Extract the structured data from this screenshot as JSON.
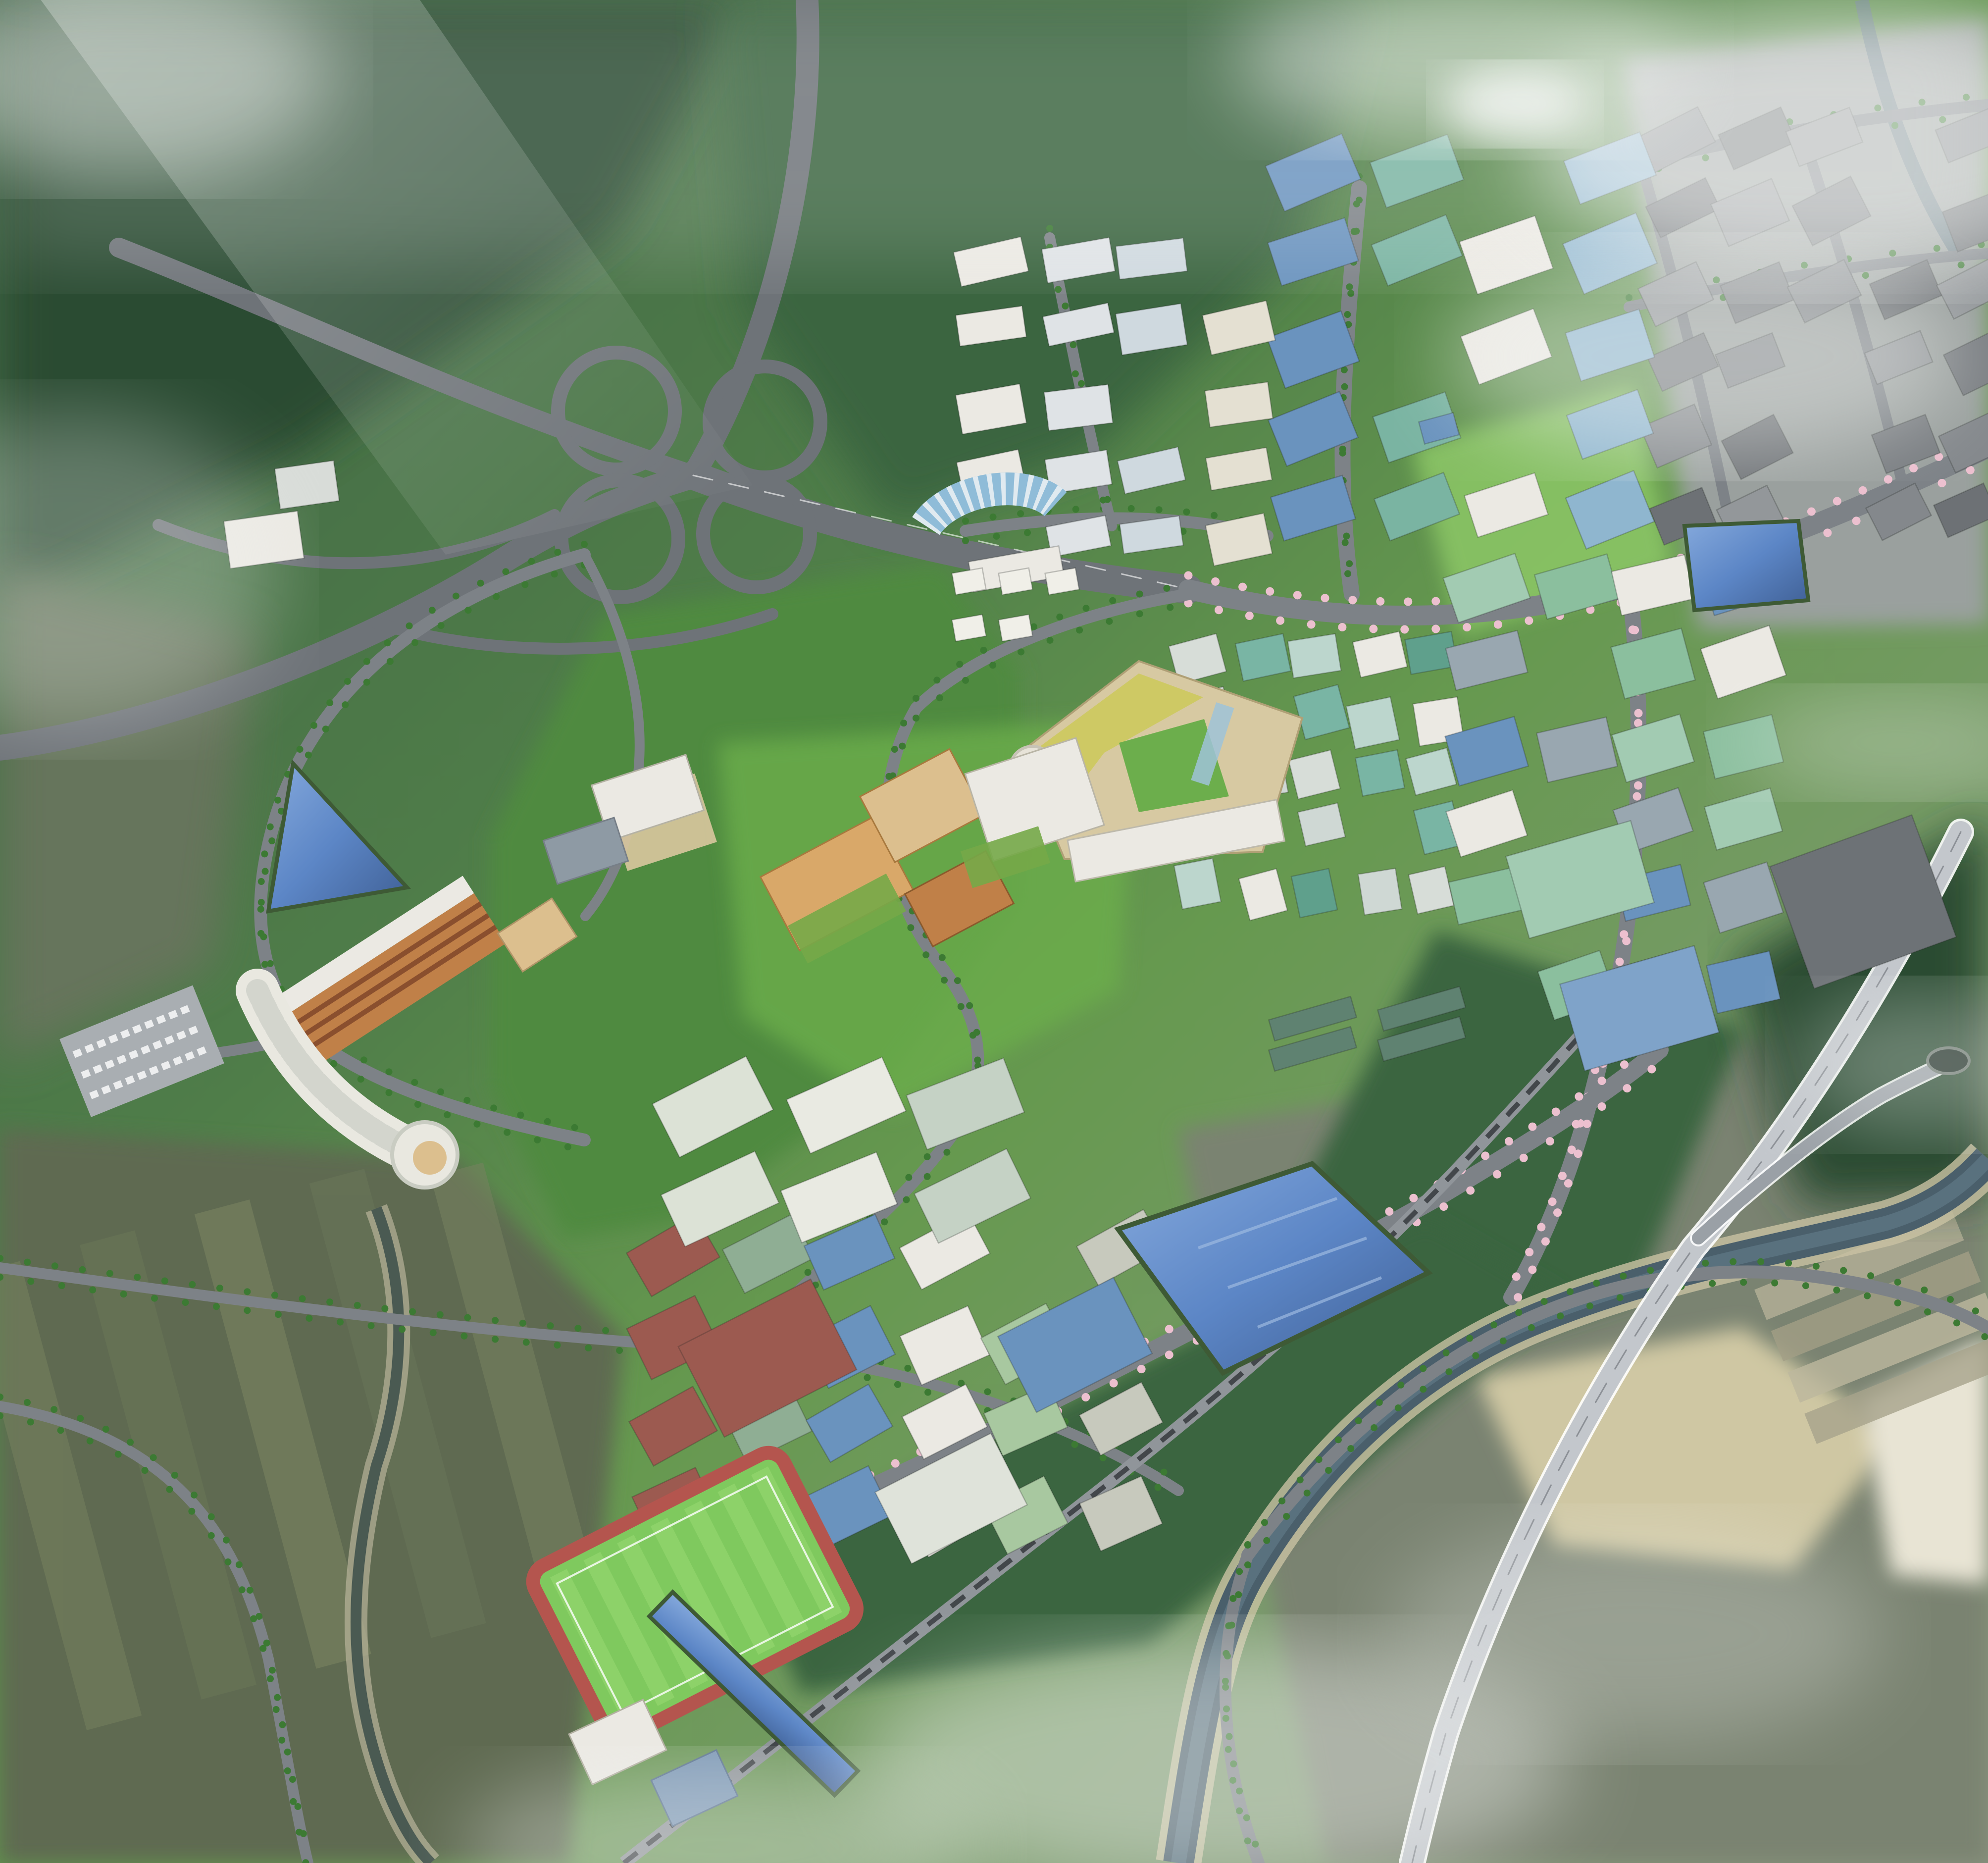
{
  "scene": {
    "type": "aerial-render",
    "title": "Bird's-eye master plan rendering of a hillside industrial / R&D complex",
    "description": "Photorealistic aerial perspective of a planned technology park set in forested hills: cloverleaf highway interchange, research campus, city-center blocks, industrial lots, hospital complex, sports field, retention ponds, cherry-blossom boulevards, railway, elevated expressway viaduct, river floodplain and farmland, with drifting clouds and fog.",
    "weather": "daylight with low clouds and fog patches",
    "visible_text": []
  },
  "palette": {
    "base": "#4f7d49",
    "forest_dark": "#2c4c33",
    "forest_mid": "#3a6540",
    "forest_bright": "#4f8a40",
    "grass_bright": "#6cae4c",
    "park_light": "#8cc766",
    "farmland": "#5f6b51",
    "field_light": "#76815e",
    "floodplain": "#7a8371",
    "sand": "#cfc7a3",
    "gray_ground": "#9aa09e",
    "road": "#6e7378",
    "street": "#7d8287",
    "road_light": "#c3c7cc",
    "rail": "#90959a",
    "rail_dark": "#43474b",
    "water_river": "#4a5f6b",
    "water_pond": "#5c86c6",
    "water_pond_deep": "#3f5f94",
    "cherry": "#ecc0cf",
    "tree": "#3c7a33",
    "tree_dark": "#2e5c2c",
    "autumn": "#c77b3a",
    "roof_white": "#ebe9e3",
    "roof_blue": "#6a93be",
    "roof_teal": "#7ab4a2",
    "roof_palegreen": "#a2cbb2",
    "roof_green": "#5f8271",
    "roof_red": "#9c5a50",
    "roof_slate": "#8e9aa4",
    "roof_dark": "#6d7276",
    "roof_gray": "#84888c",
    "facade_orange": "#c08048",
    "facade_tan": "#dcbf8e",
    "ground_tan": "#d9c69e",
    "fog": "#f4f6f4"
  },
  "features": [
    {
      "name": "highway-interchange",
      "label": "Cloverleaf highway interchange"
    },
    {
      "name": "expressway-viaduct",
      "label": "Elevated expressway viaduct with ramp and tunnel portal"
    },
    {
      "name": "railway-line",
      "label": "Railway line crossing the south of the site"
    },
    {
      "name": "cherry-boulevard",
      "label": "Cherry-blossom lined boulevards"
    },
    {
      "name": "research-campus",
      "label": "R&D campus with white lab buildings and curved glass hall"
    },
    {
      "name": "city-center-district",
      "label": "City-center blocks with teal glass towers"
    },
    {
      "name": "industrial-district-new",
      "label": "New industrial lots with blue / pale-green roofs"
    },
    {
      "name": "existing-industrial-district",
      "label": "Existing grey industrial estate under fog"
    },
    {
      "name": "hillside-campus",
      "label": "Hillside campus with orange checkered buildings and green roofs"
    },
    {
      "name": "triangular-courtyard-building",
      "label": "Triangular courtyard landmark building"
    },
    {
      "name": "hospital-complex",
      "label": "Curved hospital complex with parking lot"
    },
    {
      "name": "south-lab-district",
      "label": "Southern laboratory district with red and blue roofs"
    },
    {
      "name": "sports-field",
      "label": "Striped football pitch with red running track"
    },
    {
      "name": "retention-ponds",
      "label": "Blue retention ponds and water channel"
    },
    {
      "name": "river-floodplain",
      "label": "Meandering river with sandbars and terraced fields"
    },
    {
      "name": "farmland",
      "label": "Farmland with stream and rural roads"
    },
    {
      "name": "forest-hills",
      "label": "Forested hills and park greens"
    },
    {
      "name": "clouds",
      "label": "Low clouds and fog overlay"
    }
  ]
}
